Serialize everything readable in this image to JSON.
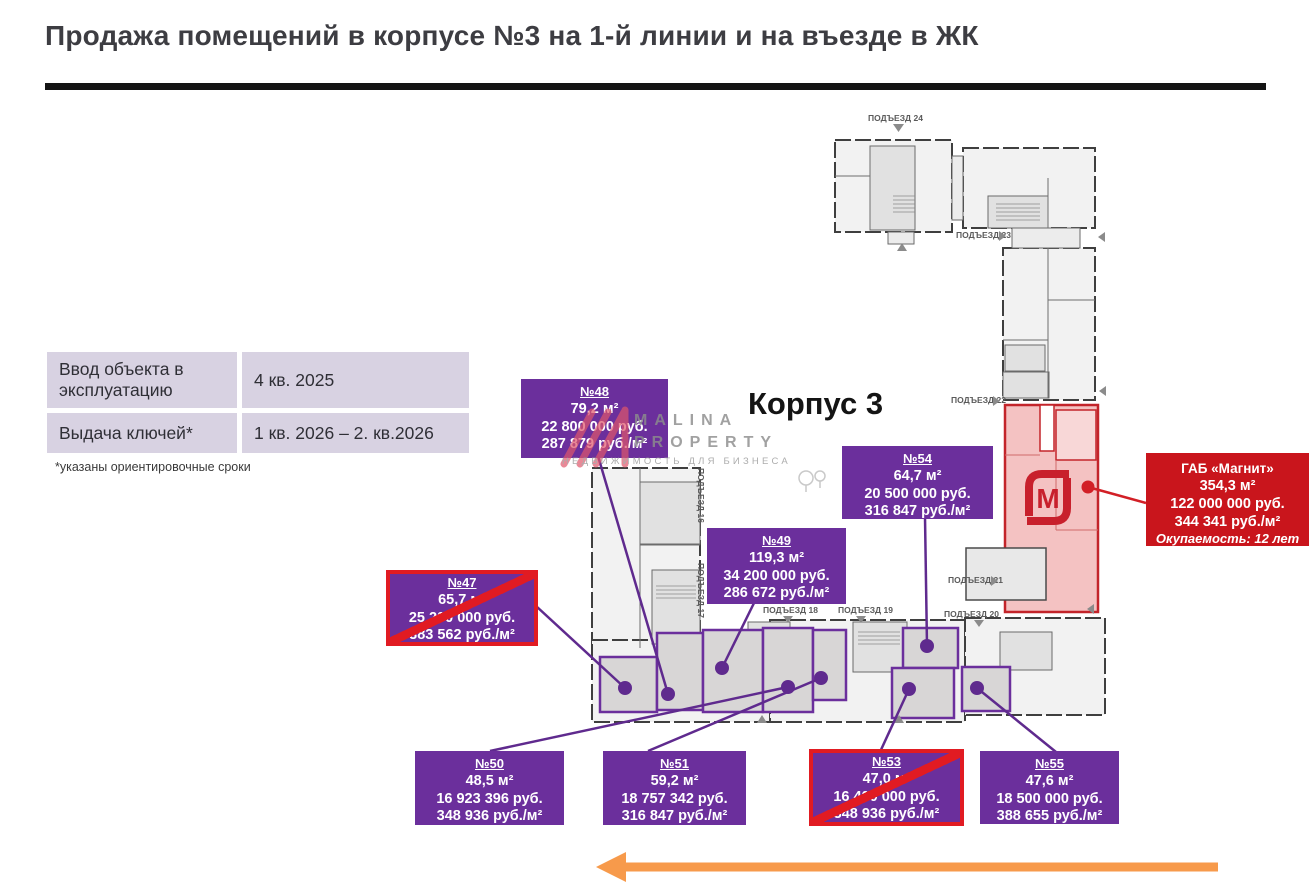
{
  "title": "Продажа помещений в корпусе №3 на 1-й линии и на въезде в ЖК",
  "info_table": {
    "rows": [
      {
        "label": "Ввод объекта в эксплуатацию",
        "value": "4 кв. 2025"
      },
      {
        "label": "Выдача ключей*",
        "value": "1 кв. 2026 – 2. кв.2026"
      }
    ],
    "footnote": "*указаны ориентировочные сроки"
  },
  "building_label": "Корпус 3",
  "watermark": {
    "line1": "MALINA",
    "line2": "PROPERTY",
    "line3": "НЕДВИЖИМОСТЬ ДЛЯ БИЗНЕСА"
  },
  "units": [
    {
      "number": "№47",
      "area": "65,7 м²",
      "price": "25 200 000 руб.",
      "price_per_m2": "383 562 руб./м²",
      "sold": true
    },
    {
      "number": "№48",
      "area": "79,2 м²",
      "price": "22 800 000 руб.",
      "price_per_m2": "287 879 руб./м²",
      "sold": false
    },
    {
      "number": "№49",
      "area": "119,3 м²",
      "price": "34 200 000 руб.",
      "price_per_m2": "286 672 руб./м²",
      "sold": false
    },
    {
      "number": "№50",
      "area": "48,5 м²",
      "price": "16 923 396 руб.",
      "price_per_m2": "348 936 руб./м²",
      "sold": false
    },
    {
      "number": "№51",
      "area": "59,2 м²",
      "price": "18 757 342 руб.",
      "price_per_m2": "316 847 руб./м²",
      "sold": false
    },
    {
      "number": "№53",
      "area": "47,0 м²",
      "price": "16 400 000 руб.",
      "price_per_m2": "348 936 руб./м²",
      "sold": true
    },
    {
      "number": "№54",
      "area": "64,7 м²",
      "price": "20 500 000 руб.",
      "price_per_m2": "316 847 руб./м²",
      "sold": false
    },
    {
      "number": "№55",
      "area": "47,6 м²",
      "price": "18 500 000 руб.",
      "price_per_m2": "388 655 руб./м²",
      "sold": false
    }
  ],
  "gab": {
    "name": "ГАБ «Магнит»",
    "area": "354,3 м²",
    "price": "122 000 000 руб.",
    "price_per_m2": "344 341 руб./м²",
    "payback": "Окупаемость: 12 лет"
  },
  "plan": {
    "entrances": [
      "ПОДЪЕЗД 16",
      "ПОДЪЕЗД 17",
      "ПОДЪЕЗД 18",
      "ПОДЪЕЗД 19",
      "ПОДЪЕЗД 20",
      "ПОДЪЕЗД 21",
      "ПОДЪЕЗД 22",
      "ПОДЪЕЗД 23",
      "ПОДЪЕЗД 24"
    ],
    "magnit_logo_letter": "М"
  },
  "colors": {
    "accent_purple": "#6B2F9C",
    "magnit_red": "#C9151C",
    "sold_cross_red": "#E11B22",
    "magnit_area_fill": "#F4C2C2",
    "arrow_orange": "#F79A4B",
    "table_lavender": "#D8D2E2"
  }
}
